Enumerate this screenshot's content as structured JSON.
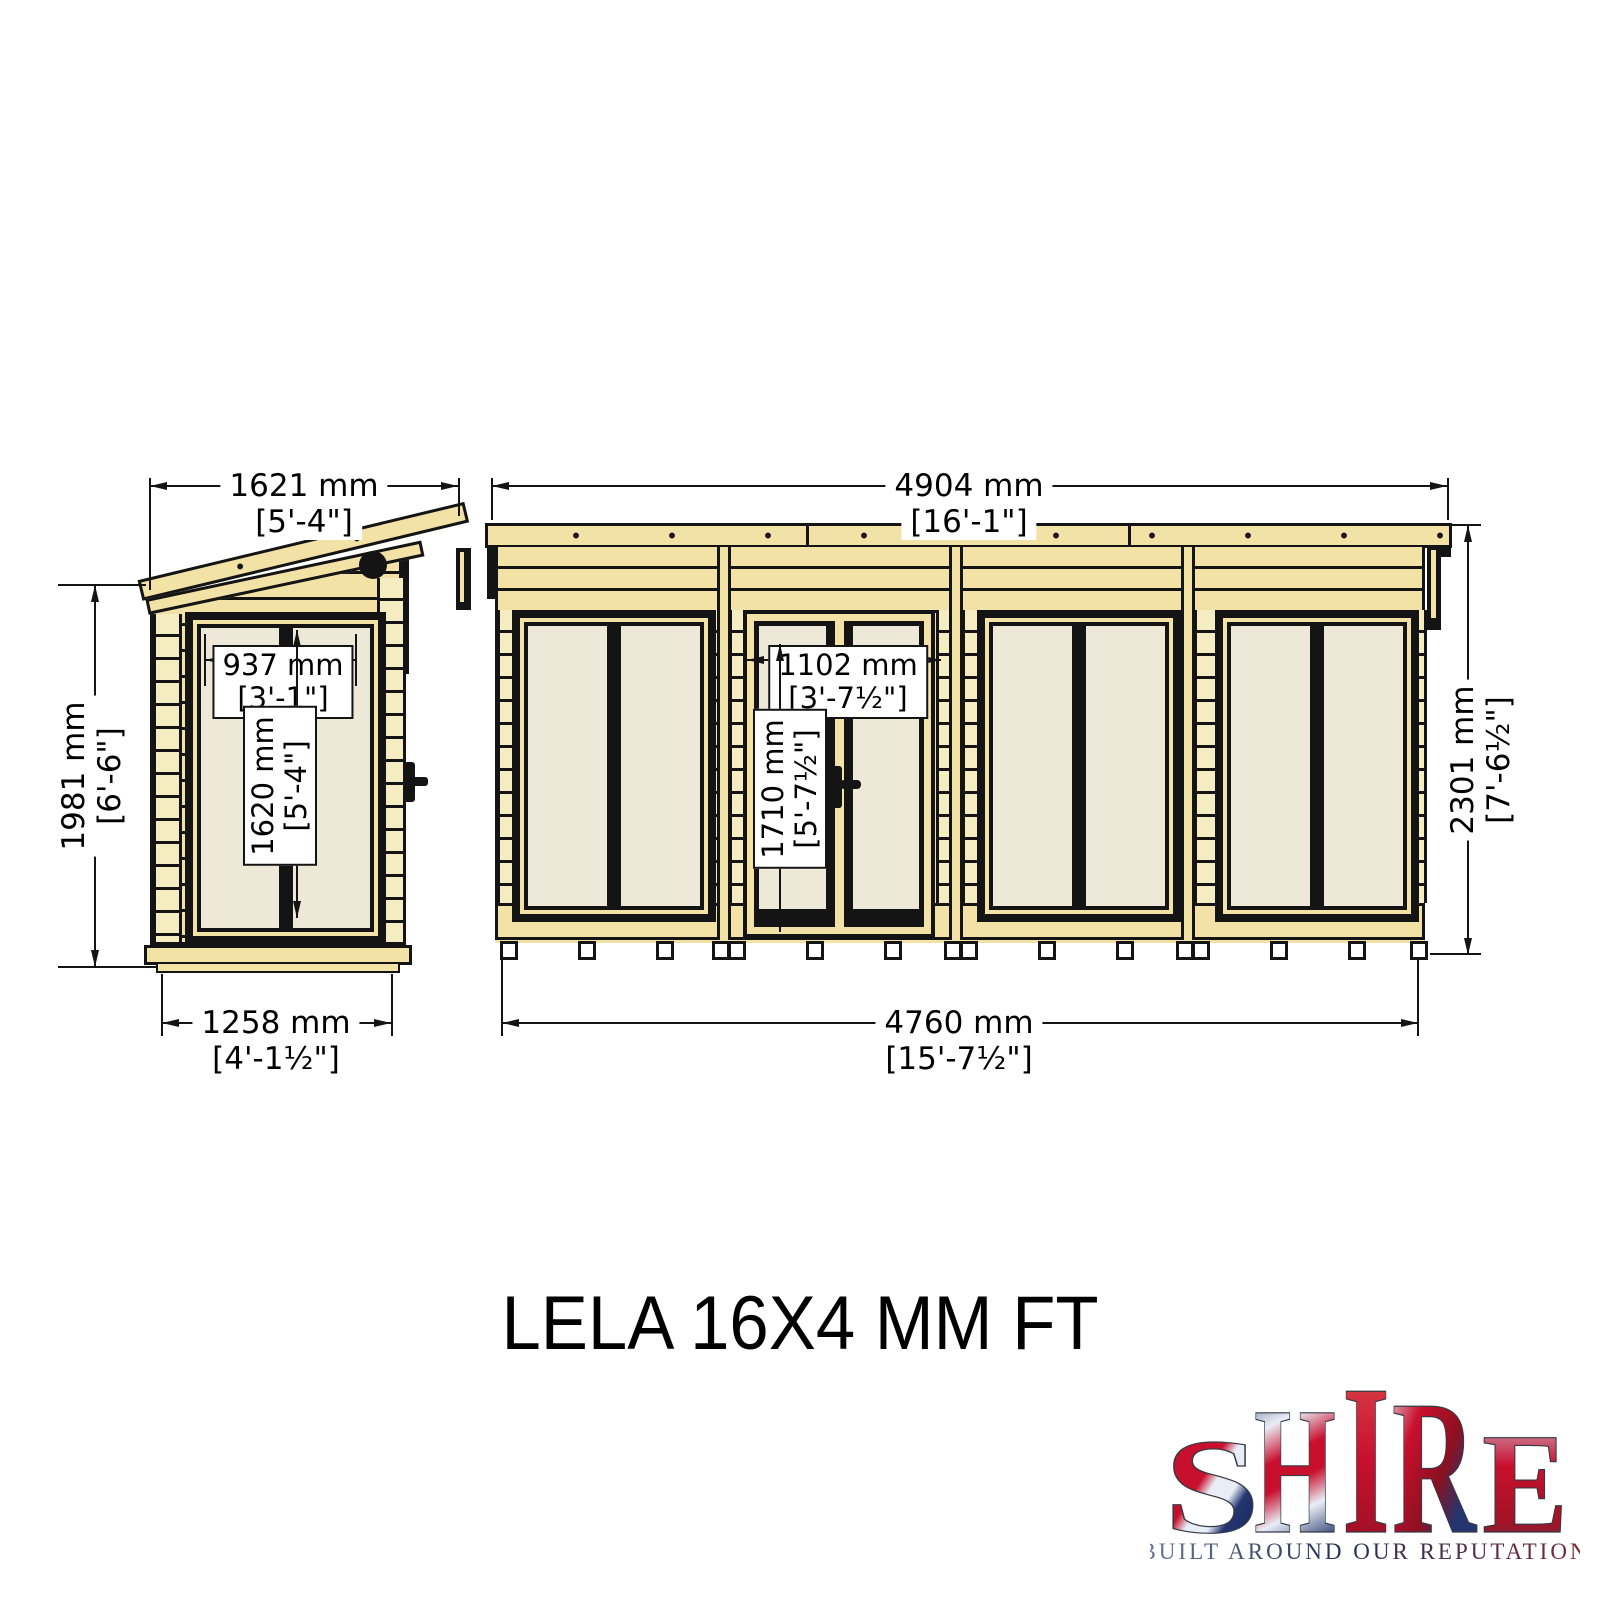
{
  "title": "LELA 16X4 MM FT",
  "side_view": {
    "label": "side elevation",
    "dim_roof_width": {
      "mm": "1621 mm",
      "ft": "[5'-4\"]"
    },
    "dim_wall_height": {
      "mm": "1981 mm",
      "ft": "[6'-6\"]"
    },
    "dim_window_width": {
      "mm": "937 mm",
      "ft": "[3'-1\"]"
    },
    "dim_window_height": {
      "mm": "1620 mm",
      "ft": "[5'-4\"]"
    },
    "dim_base_width": {
      "mm": "1258 mm",
      "ft": "[4'-1½\"]"
    }
  },
  "front_view": {
    "label": "front elevation",
    "dim_roof_width": {
      "mm": "4904 mm",
      "ft": "[16'-1\"]"
    },
    "dim_door_width": {
      "mm": "1102 mm",
      "ft": "[3'-7½\"]"
    },
    "dim_door_height": {
      "mm": "1710 mm",
      "ft": "[5'-7½\"]"
    },
    "dim_wall_height": {
      "mm": "2301 mm",
      "ft": "[7'-6½\"]"
    },
    "dim_base_width": {
      "mm": "4760 mm",
      "ft": "[15'-7½\"]"
    }
  },
  "logo": {
    "letters": [
      "S",
      "H",
      "I",
      "R",
      "E"
    ],
    "tagline": "BUILT AROUND OUR REPUTATION"
  },
  "colors": {
    "wood": "#f2e2a6",
    "wood_light": "#f6ecc2",
    "glass": "#eee8d9",
    "outline": "#141414",
    "flag_red": "#c8102e",
    "flag_blue": "#012169"
  }
}
